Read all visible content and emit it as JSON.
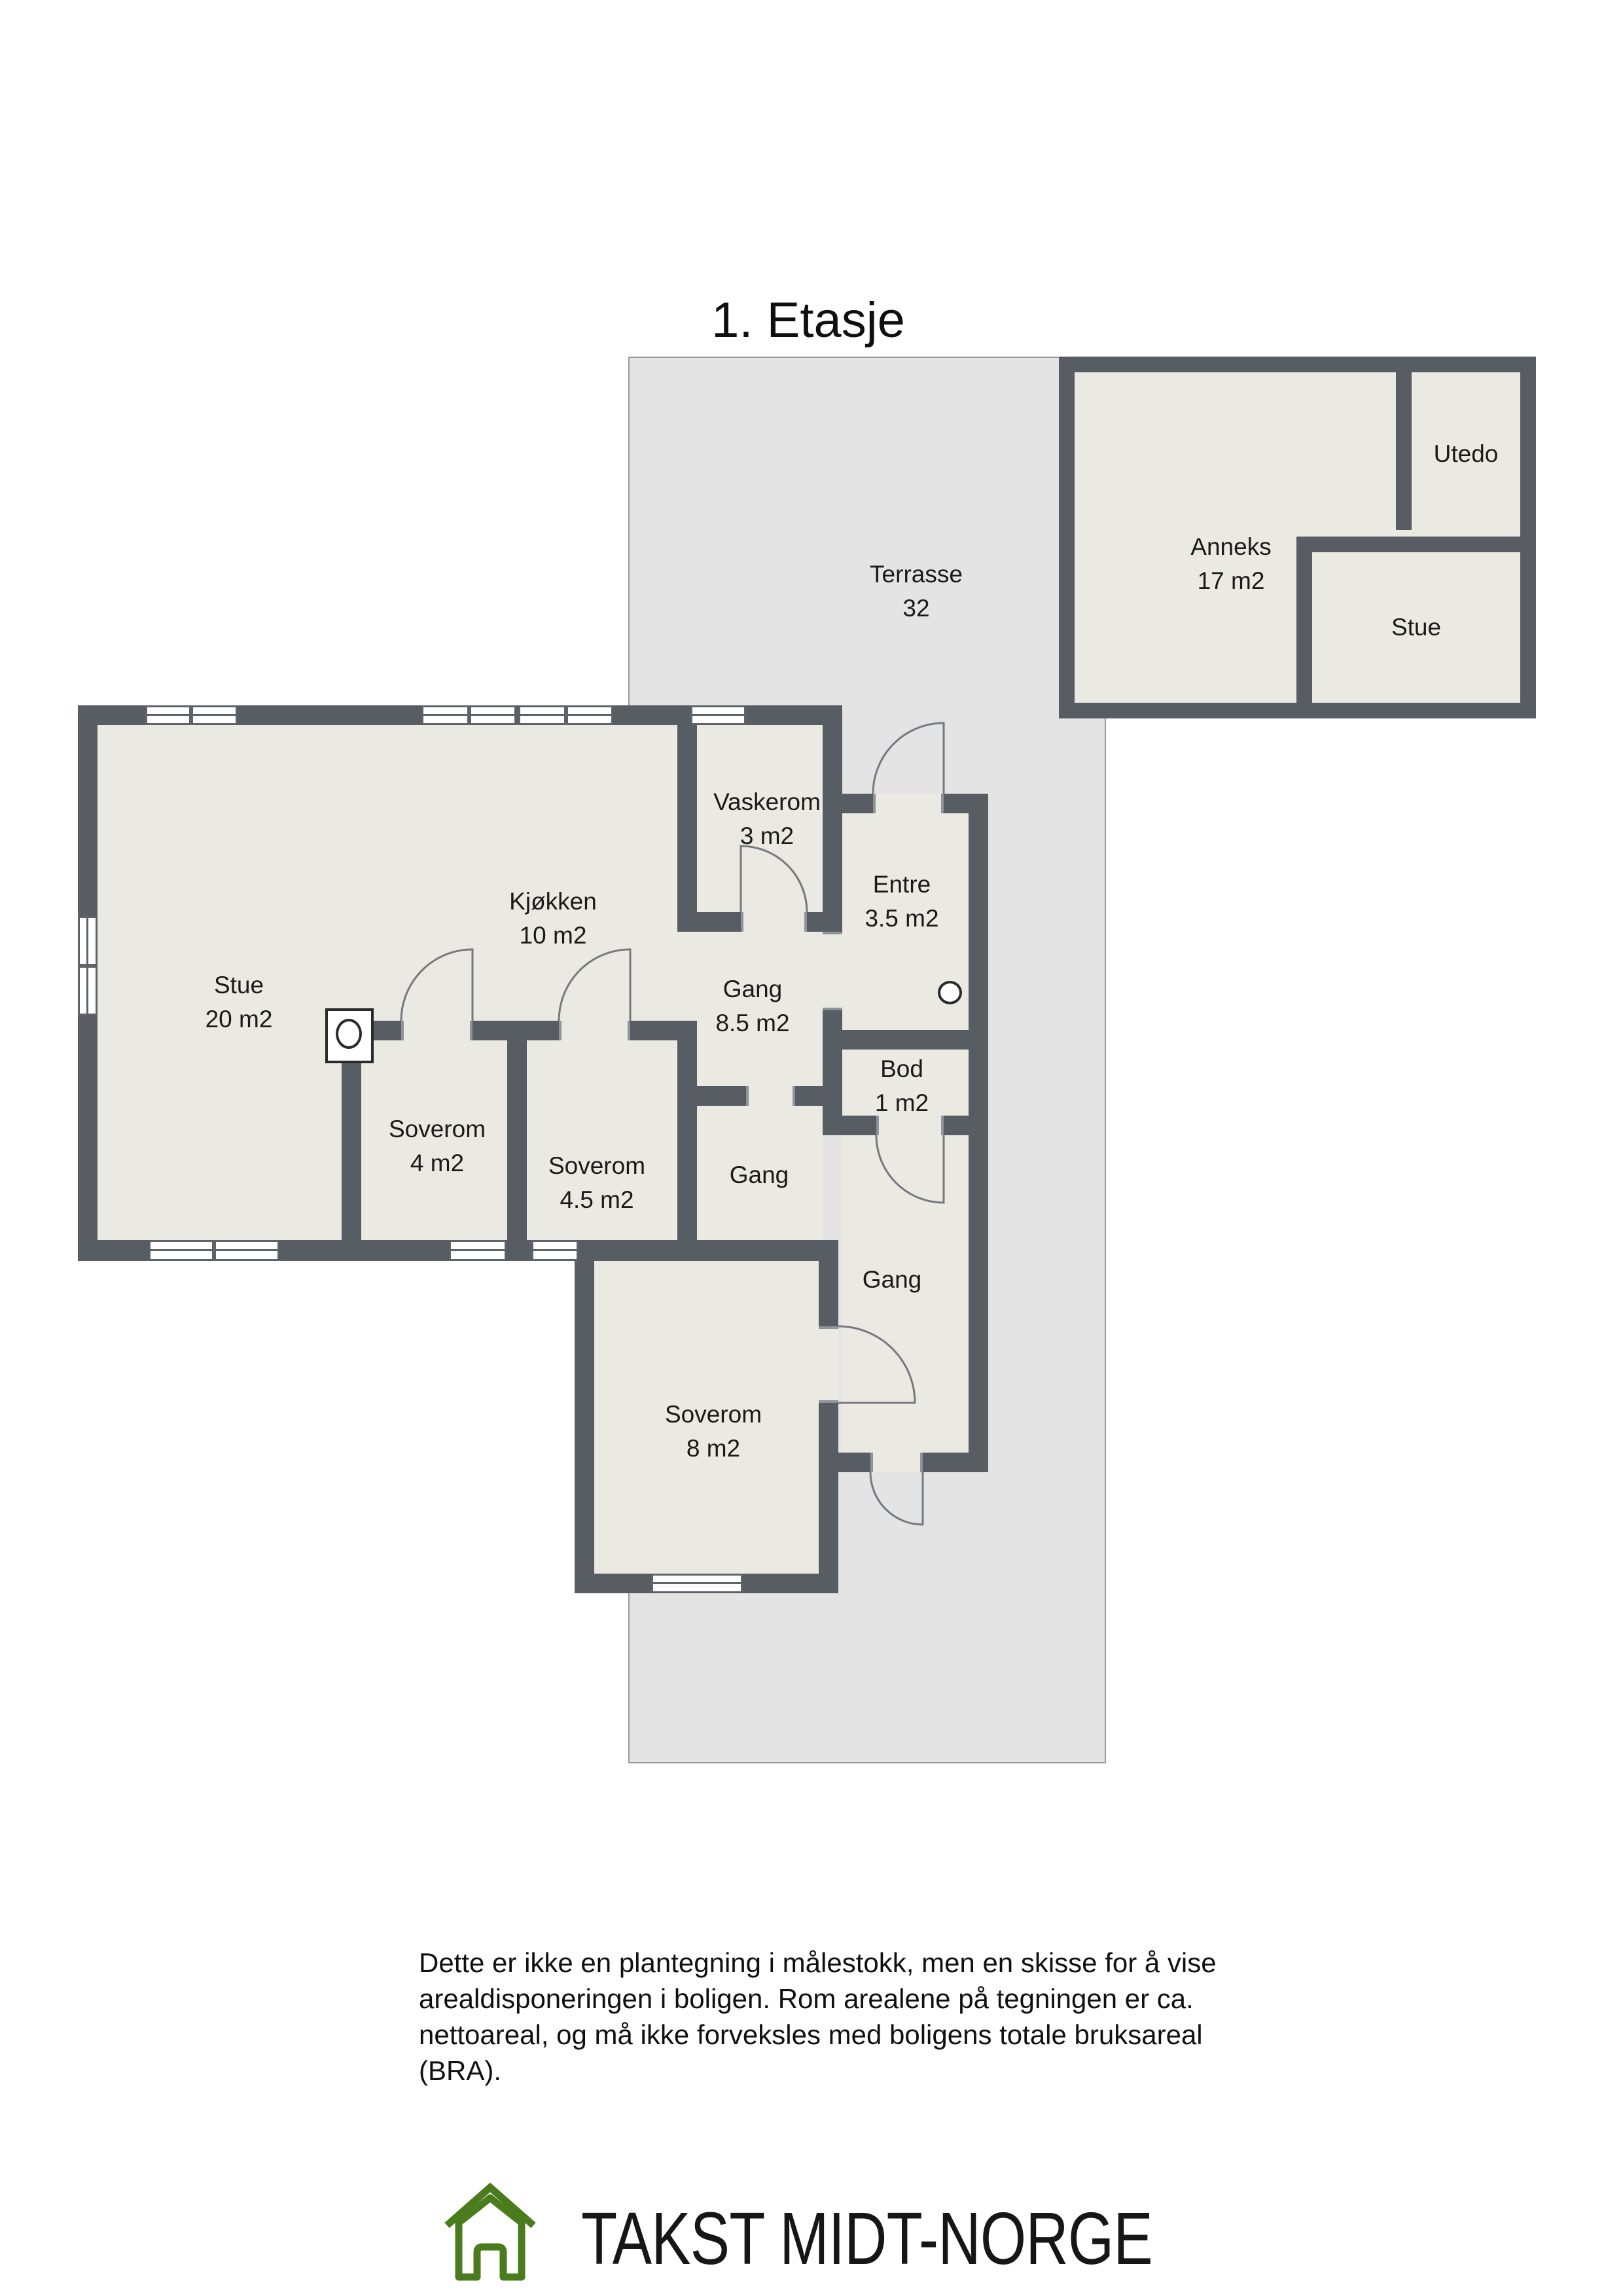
{
  "title": "1. Etasje",
  "colors": {
    "wall": "#585d64",
    "room_fill": "#eaeae2",
    "terrace_fill": "#e4e4e5",
    "logo_green": "#4a7b1d",
    "text": "#1a1a1a"
  },
  "rooms": {
    "terrasse": {
      "name": "Terrasse",
      "area": "32"
    },
    "anneks": {
      "name": "Anneks",
      "area": "17 m2"
    },
    "utedo": {
      "name": "Utedo"
    },
    "anneks_stue": {
      "name": "Stue"
    },
    "stue": {
      "name": "Stue",
      "area": "20 m2"
    },
    "kjokken": {
      "name": "Kjøkken",
      "area": "10 m2"
    },
    "vaskerom": {
      "name": "Vaskerom",
      "area": "3 m2"
    },
    "entre": {
      "name": "Entre",
      "area": "3.5 m2"
    },
    "gang_main": {
      "name": "Gang",
      "area": "8.5 m2"
    },
    "bod": {
      "name": "Bod",
      "area": "1 m2"
    },
    "gang_mid": {
      "name": "Gang"
    },
    "gang_wing": {
      "name": "Gang"
    },
    "soverom4": {
      "name": "Soverom",
      "area": "4 m2"
    },
    "soverom45": {
      "name": "Soverom",
      "area": "4.5 m2"
    },
    "soverom8": {
      "name": "Soverom",
      "area": "8 m2"
    }
  },
  "disclaimer": {
    "lines": [
      "Dette er ikke en plantegning i målestokk, men en skisse for å vise",
      "arealdisponeringen i boligen. Rom arealene på tegningen er ca.",
      "nettoareal, og må ikke forveksles med boligens totale bruksareal",
      "(BRA)."
    ]
  },
  "logo": {
    "text": "TAKST MIDT-NORGE"
  }
}
